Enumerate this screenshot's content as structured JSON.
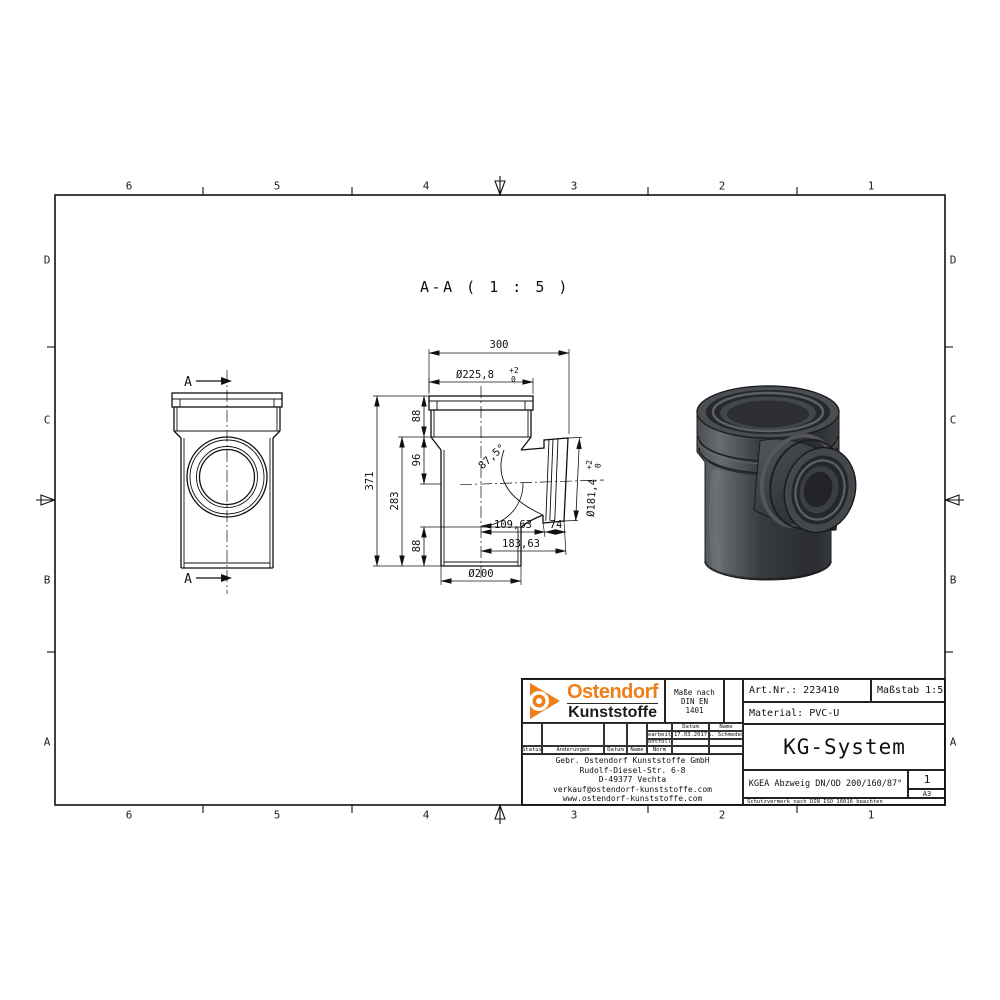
{
  "meta": {
    "accent_orange": "#ee7f1b",
    "line_color": "#111111",
    "render_dark": "#35383c",
    "background": "#ffffff"
  },
  "border": {
    "top_numbers": [
      "6",
      "5",
      "4",
      "3",
      "2",
      "1"
    ],
    "bottom_numbers": [
      "6",
      "5",
      "4",
      "3",
      "2",
      "1"
    ],
    "left_letters": [
      "D",
      "C",
      "B",
      "A"
    ],
    "right_letters": [
      "D",
      "C",
      "B",
      "A"
    ]
  },
  "view_label": "A-A ( 1 : 5 )",
  "section_marks": {
    "label": "A"
  },
  "dimensions": {
    "overall_width": "300",
    "socket_od": "Ø225,8",
    "socket_od_tol_plus": "+2",
    "socket_od_tol_minus": "0",
    "overall_height": "371",
    "height_branch": "283",
    "seg_top": "88",
    "seg_mid": "96",
    "seg_bottom": "88",
    "branch_angle": "87,5°",
    "branch_od": "Ø181,4",
    "branch_od_tol_plus": "+2",
    "branch_od_tol_minus": "0",
    "branch_offset": "109,63",
    "branch_socket_depth": "74",
    "branch_total": "183,63",
    "pipe_od": "Ø200"
  },
  "title_block": {
    "logo_line1": "Ostendorf",
    "logo_line2": "Kunststoffe",
    "standard_lines": [
      "Maße nach",
      "DIN EN",
      "1401"
    ],
    "art_nr": "Art.Nr.: 223410",
    "scale": "Maßstab 1:5",
    "material": "Material: PVC-U",
    "system": "KG-System",
    "description": "KGEA Abzweig DN/OD 200/160/87°",
    "sheet": "1",
    "format": "A3",
    "protection_note": "Schutzvermerk nach DIN ISO 16016 beachten",
    "revision": {
      "col_datum": "Datum",
      "col_name": "Name",
      "row_bearb": "Bearbeit.",
      "bearb_datum": "17.03.2017",
      "bearb_name": "A. Schmedes",
      "row_kontroll": "Kontroll.",
      "row_norm": "Norm",
      "status": "Status",
      "aenderungen": "Änderungen",
      "datum": "Datum",
      "name": "Name"
    },
    "address": [
      "Gebr. Ostendorf Kunststoffe GmbH",
      "Rudolf-Diesel-Str. 6-8",
      "D-49377 Vechta",
      "verkauf@ostendorf-kunststoffe.com",
      "www.ostendorf-kunststoffe.com"
    ]
  }
}
